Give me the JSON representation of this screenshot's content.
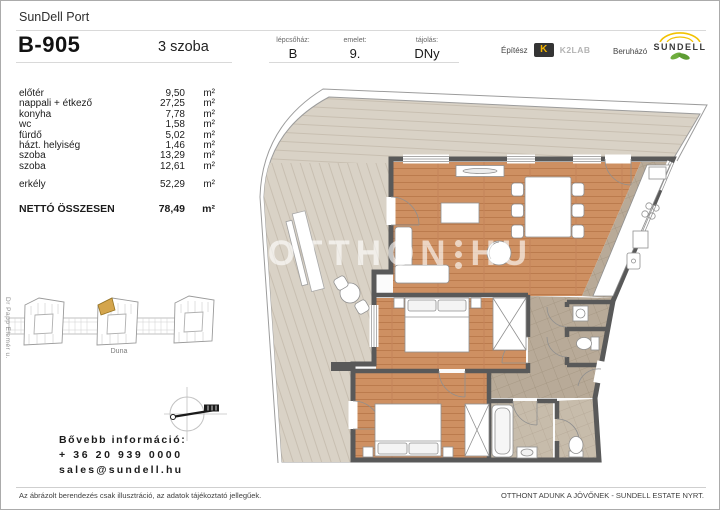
{
  "header": {
    "project": "SunDell Port",
    "unit_id": "B-905",
    "room_count": "3 szoba",
    "fields": [
      {
        "label": "lépcsőház:",
        "value": "B"
      },
      {
        "label": "emelet:",
        "value": "9."
      },
      {
        "label": "tájolás:",
        "value": "DNy"
      }
    ],
    "architect": {
      "label": "Építész",
      "mark": "K",
      "name": "K2LAB"
    },
    "developer": {
      "label": "Beruházó",
      "name": "SUNDELL"
    }
  },
  "area_table": {
    "rows": [
      {
        "name": "előtér",
        "value": "9,50",
        "unit": "m²"
      },
      {
        "name": "nappali + étkező",
        "value": "27,25",
        "unit": "m²"
      },
      {
        "name": "konyha",
        "value": "7,78",
        "unit": "m²"
      },
      {
        "name": "wc",
        "value": "1,58",
        "unit": "m²"
      },
      {
        "name": "fürdő",
        "value": "5,02",
        "unit": "m²"
      },
      {
        "name": "házt. helyiség",
        "value": "1,46",
        "unit": "m²"
      },
      {
        "name": "szoba",
        "value": "13,29",
        "unit": "m²"
      },
      {
        "name": "szoba",
        "value": "12,61",
        "unit": "m²"
      }
    ],
    "balcony": {
      "name": "erkély",
      "value": "52,29",
      "unit": "m²"
    },
    "total": {
      "name": "NETTÓ ÖSSZESEN",
      "value": "78,49",
      "unit": "m²"
    }
  },
  "site_map": {
    "street": "Dr Papp Elemér u.",
    "river_label": "Duna"
  },
  "contact": {
    "heading": "Bővebb információ:",
    "phone": "+ 36 20 939 0000",
    "email": "sales@sundell.hu"
  },
  "watermark": {
    "left": "UJOTTHON",
    "right": "HU"
  },
  "footer": {
    "disclaimer": "Az ábrázolt berendezés csak illusztráció, az adatok tájékoztató jellegűek.",
    "slogan": "OTTHONT ADUNK A JÖVŐNEK - SUNDELL ESTATE NYRT."
  },
  "colors": {
    "wood_floor": "#ce9062",
    "deck": "#d9d2c6",
    "tile": "#b8aa98",
    "tile_light": "#c7bcab",
    "wall": "#595959",
    "highlight_unit": "#d4a54c",
    "logo_yellow": "#f3b300",
    "logo_green": "#6fae3e"
  }
}
